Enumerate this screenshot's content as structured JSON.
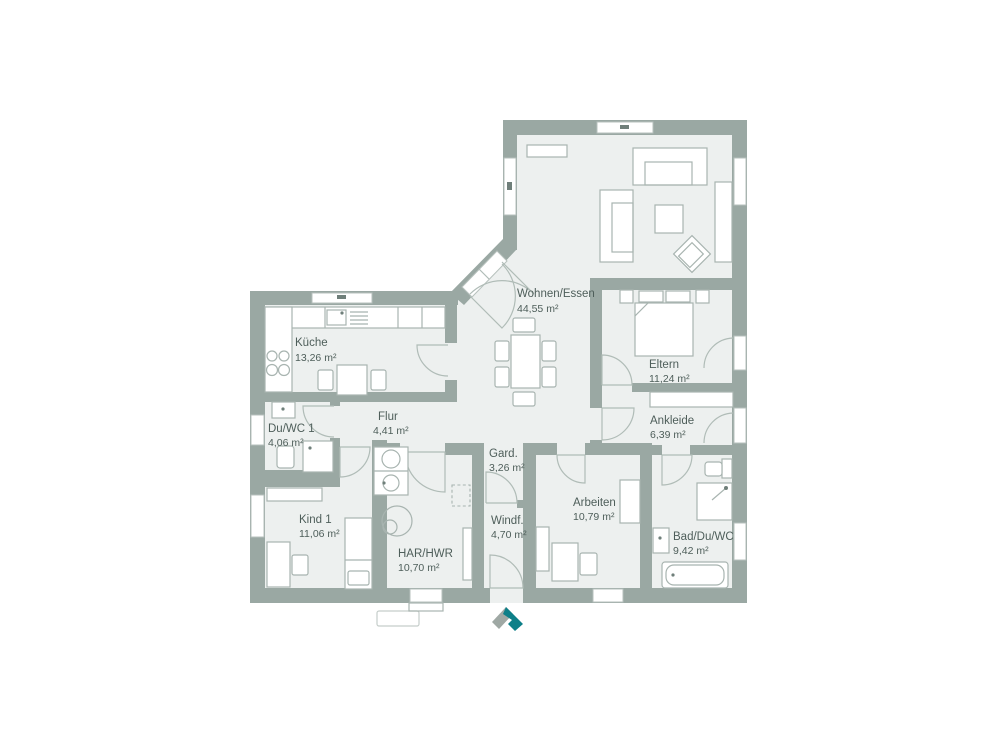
{
  "title": "Grundriss Erdgeschoss",
  "colors": {
    "wall": "#9aa8a3",
    "room_fill": "#edf0ef",
    "furniture_line": "#a8b4b0",
    "label_text": "#4e5e5a",
    "logo_teal": "#0d7f88",
    "logo_gray": "#9fa8a4"
  },
  "rooms": [
    {
      "name": "Wohnen/Essen",
      "area": "44,55 m²"
    },
    {
      "name": "Küche",
      "area": "13,26 m²"
    },
    {
      "name": "Eltern",
      "area": "11,24 m²"
    },
    {
      "name": "Ankleide",
      "area": "6,39 m²"
    },
    {
      "name": "Flur",
      "area": "4,41 m²"
    },
    {
      "name": "Du/WC 1",
      "area": "4,06 m²"
    },
    {
      "name": "Gard.",
      "area": "3,26 m²"
    },
    {
      "name": "Windf.",
      "area": "4,70 m²"
    },
    {
      "name": "Arbeiten",
      "area": "10,79 m²"
    },
    {
      "name": "Kind 1",
      "area": "11,06 m²"
    },
    {
      "name": "HAR/HWR",
      "area": "10,70 m²"
    },
    {
      "name": "Bad/Du/WC",
      "area": "9,42 m²"
    }
  ],
  "branding": {
    "logo": "roof-chevron"
  }
}
